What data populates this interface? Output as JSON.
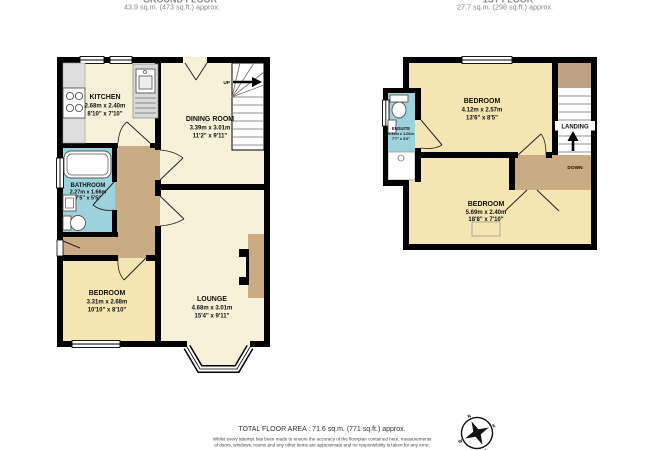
{
  "ground_floor": {
    "title": "GROUND FLOOR",
    "area": "43.9 sq.m. (473 sq.ft.) approx.",
    "stairs_label": "UP",
    "rooms": {
      "kitchen": {
        "name": "KITCHEN",
        "metric": "2.68m x 2.40m",
        "imperial": "8'10\" x 7'10\""
      },
      "dining": {
        "name": "DINING ROOM",
        "metric": "3.39m x 3.01m",
        "imperial": "11'2\" x 9'11\""
      },
      "bathroom": {
        "name": "BATHROOM",
        "metric": "2.27m x 1.66m",
        "imperial": "7'5\" x 5'5\""
      },
      "bedroom": {
        "name": "BEDROOM",
        "metric": "3.31m x 2.68m",
        "imperial": "10'10\" x 8'10\""
      },
      "lounge": {
        "name": "LOUNGE",
        "metric": "4.68m x 3.01m",
        "imperial": "15'4\" x 9'11\""
      }
    }
  },
  "first_floor": {
    "title": "1ST FLOOR",
    "area": "27.7 sq.m. (298 sq.ft.) approx.",
    "landing_label": "LANDING",
    "down_label": "DOWN",
    "rooms": {
      "bedroom1": {
        "name": "BEDROOM",
        "metric": "4.12m x 2.57m",
        "imperial": "13'6\" x 8'5\""
      },
      "ensuite": {
        "name": "ENSUITE",
        "metric": "2.31m x 1.06m",
        "imperial": "7'7\" x 3'6\""
      },
      "bedroom2": {
        "name": "BEDROOM",
        "metric": "5.69m x 2.40m",
        "imperial": "18'8\" x 7'10\""
      }
    }
  },
  "footer": {
    "total": "TOTAL FLOOR AREA : 71.6 sq.m. (771 sq.ft.) approx.",
    "disclaimer_line1": "Whilst every attempt has been made to ensure the accuracy of the floorplan contained here, measurements",
    "disclaimer_line2": "of doors, windows, rooms and any other items are approximate and no responsibility is taken for any error,"
  },
  "compass": {
    "north": "N",
    "east": "E",
    "south": "S",
    "west": "W"
  },
  "colors": {
    "wall": "#000000",
    "room_cream": "#f7f1da",
    "bedroom_cream": "#f4e5b2",
    "bathroom_blue": "#9ed2dd",
    "hall_tan": "#c9ab84",
    "counter_grey": "#dedede",
    "title_grey": "#878787"
  }
}
